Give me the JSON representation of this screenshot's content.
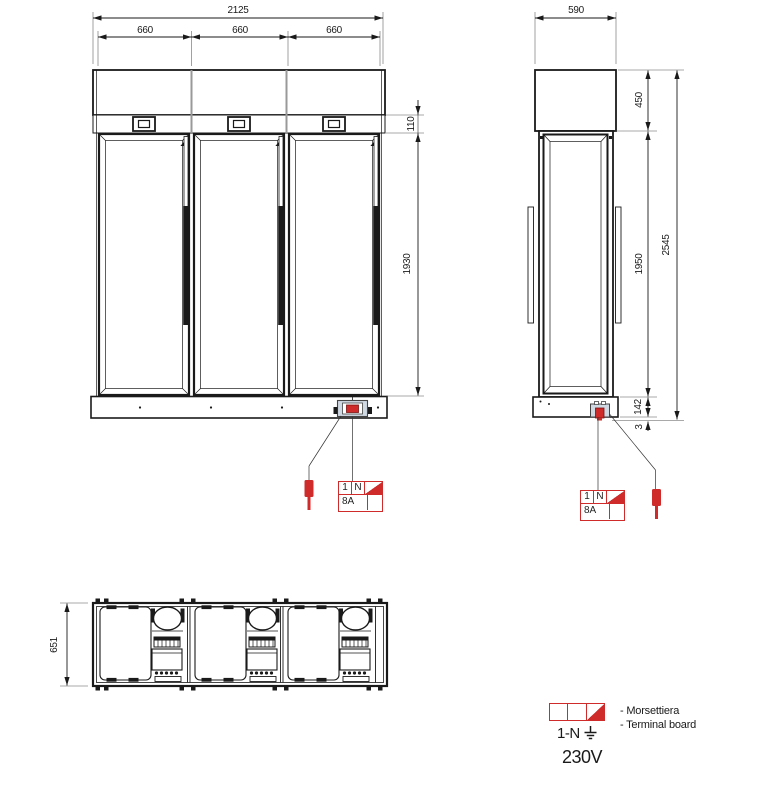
{
  "dims": {
    "front": {
      "total_width": "2125",
      "door_widths": [
        "660",
        "660",
        "660"
      ],
      "header_height": "110",
      "door_height": "1930"
    },
    "side": {
      "depth": "590",
      "canopy_height": "450",
      "glass_height": "1950",
      "base_height": "142",
      "foot_height": "3",
      "total_height": "2545"
    },
    "top": {
      "depth": "651"
    }
  },
  "terminal": {
    "phase": "1",
    "neutral": "N",
    "rating": "8A"
  },
  "legend": {
    "supply": "1-N",
    "voltage": "230V",
    "note_it": "- Morsettiera",
    "note_en": "- Terminal board"
  },
  "colors": {
    "accent_red": "#cf2b2b",
    "line": "#1a1a1a",
    "terminal_fill": "#cfd9e4"
  }
}
